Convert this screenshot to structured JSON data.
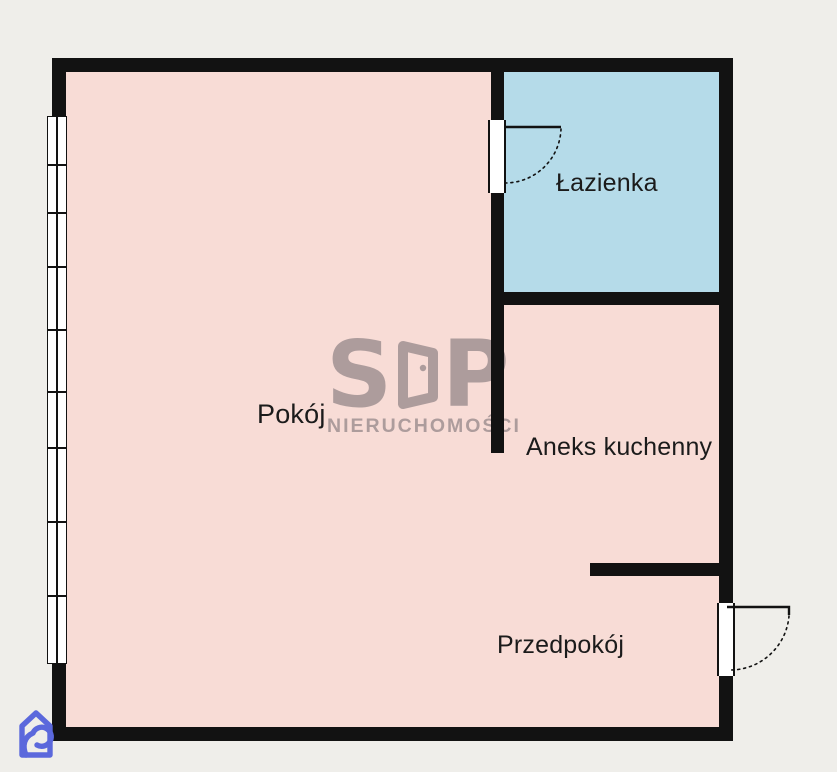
{
  "colors": {
    "canvas-bg": "#efeeea",
    "room-pink": "#f8dcd6",
    "room-blue": "#b5dbe9",
    "wall-black": "#121212",
    "label-text": "#1b1b1b",
    "symbol-white": "#ffffff",
    "watermark-gray": "rgba(70,66,76,0.42)",
    "logo-blue": "#5b68dc"
  },
  "rooms": {
    "pokoj": {
      "label": "Pokój"
    },
    "lazienka": {
      "label": "Łazienka"
    },
    "aneks_kuchenny": {
      "label": "Aneks kuchenny"
    },
    "przedpokoj": {
      "label": "Przedpokój"
    }
  },
  "watermark": {
    "letter_s": "S",
    "letter_p": "P",
    "door_glyph": "stylized-letter-d-as-open-door",
    "subtitle": "NIERUCHOMOŚCI"
  },
  "logo": {
    "name": "house-with-spiral-agency-logo"
  }
}
